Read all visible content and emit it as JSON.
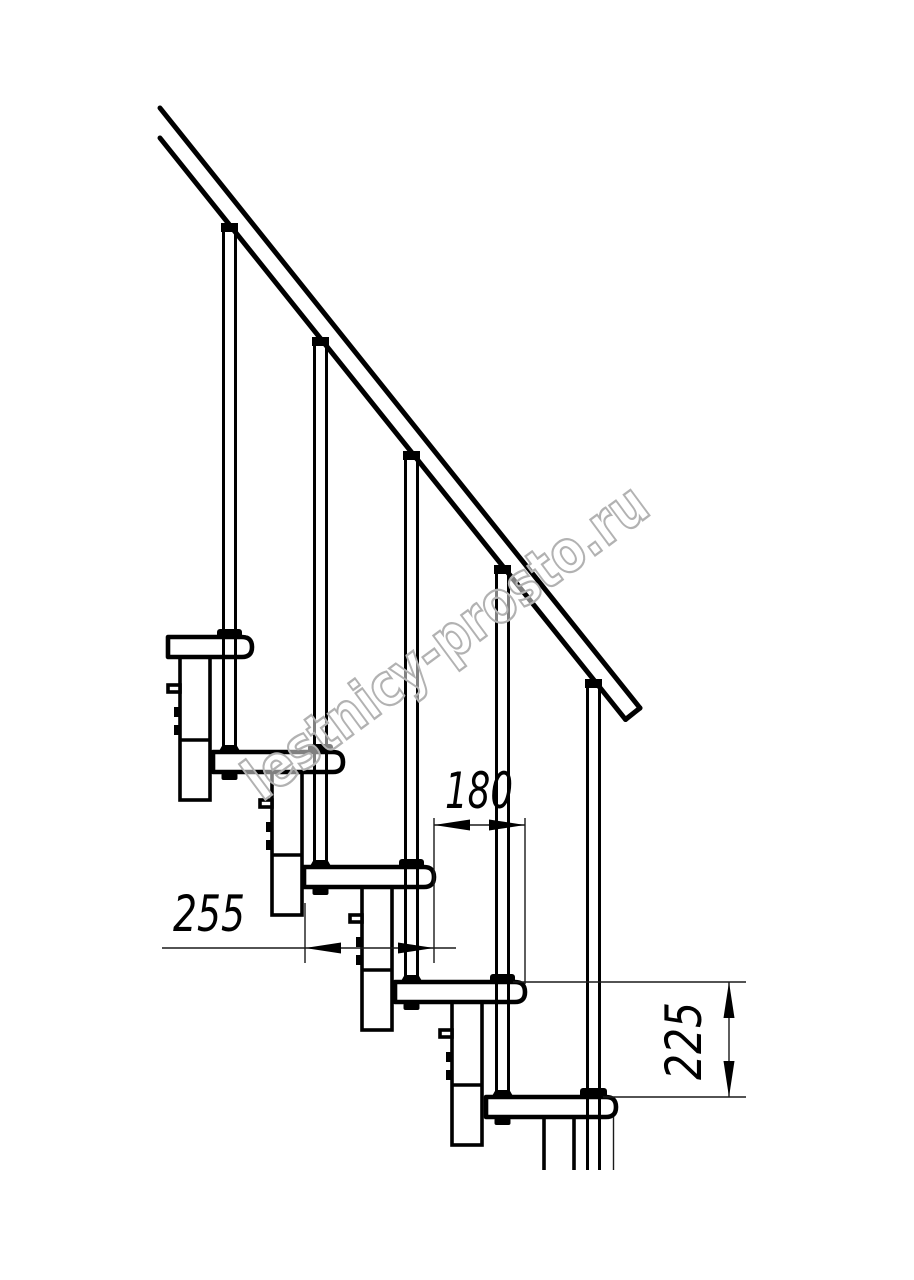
{
  "page": {
    "background": "#ffffff"
  },
  "drawing": {
    "kind": "staircase-side-view-line-drawing",
    "line_color": "#000000",
    "watermark": {
      "text": "lestnicy-prosto.ru",
      "outline_color": "#b2b2b2"
    },
    "dimensions": {
      "run": {
        "value": "180",
        "orientation": "horizontal"
      },
      "tread_depth": {
        "value": "255",
        "orientation": "horizontal"
      },
      "rise": {
        "value": "225",
        "orientation": "vertical"
      }
    }
  }
}
